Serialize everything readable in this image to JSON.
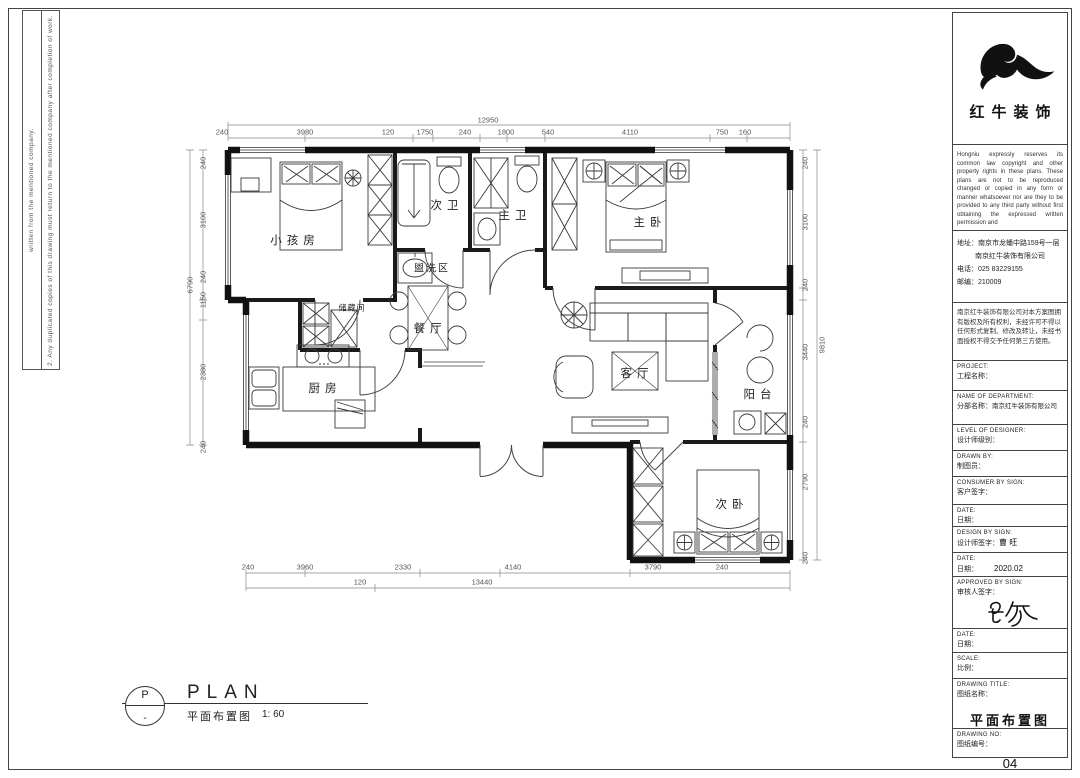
{
  "left_strip": {
    "line1": "written from the mentioned company.",
    "line2": "2. Any duplicated copies of this drawing must return to the mentioned company after completion of work."
  },
  "logo": {
    "name": "红牛装饰"
  },
  "tb": {
    "disclaimer_en": "Hongniu expressly reserves its common law copyright and other property rights in these plans. These plans are not to be reproduced changed or copied in any form or manner whatsoever nor are they to be provided to any third party without first obtaining the expressed written permission and",
    "addr1": "地址：南京市龙蟠中路159号一层",
    "addr2": "南京红牛装饰有限公司",
    "phone": "电话：025 83229155",
    "post": "邮编：210009",
    "disclaimer_cn": "南京红牛装饰有限公司对本方案图拥有版权及所有权利，未经许可不得以任何形式复制、修改及转让，未经书面授权不得交予任何第三方使用。",
    "f1e": "PROJECT:",
    "f1c": "工程名称：",
    "f2e": "NAME OF DEPARTMENT:",
    "f2c": "分部名称：",
    "f2v": "南京红牛装饰有限公司",
    "f3e": "LEVEL OF DESIGNER:",
    "f3c": "设计师级别：",
    "f4e": "DRAWN BY:",
    "f4c": "制图员：",
    "f5e": "CONSUMER BY SIGN:",
    "f5c": "客户签字：",
    "f6e": "DATE:",
    "f6c": "日期：",
    "f7e": "DESIGN BY SIGN:",
    "f7c": "设计师签字：",
    "f7v": "曹 旺",
    "f8e": "DATE:",
    "f8c": "日期：",
    "f8v": "2020.02",
    "f9e": "APPROVED BY SIGN:",
    "f9c": "审核人签字：",
    "f10e": "DATE:",
    "f10c": "日期：",
    "f11e": "SCALE:",
    "f11c": "比例：",
    "f12e": "DRAWING TITLE:",
    "f12c": "图纸名称：",
    "f12v": "平面布置图",
    "f13e": "DRAWING NO:",
    "f13c": "图纸编号：",
    "f13v": "04"
  },
  "rooms": {
    "kids": "小孩房",
    "bath2": "次卫",
    "bath1": "主卫",
    "master": "主卧",
    "wash": "盥洗区",
    "storage": "储藏间",
    "dining": "餐厅",
    "kitchen": "厨房",
    "living": "客厅",
    "balcony": "阳台",
    "bed2": "次卧"
  },
  "dims": {
    "top_total": "12950",
    "top": [
      "240",
      "3980",
      "120",
      "1750",
      "240",
      "1800",
      "540",
      "4110",
      "750",
      "160"
    ],
    "bottom": [
      "240",
      "3960",
      "2330",
      "4140",
      "3790",
      "240"
    ],
    "bottom_sub": "120",
    "bottom_total": "13440",
    "left": [
      "240",
      "3100",
      "240",
      "1150",
      "2380",
      "240"
    ],
    "left_total": "6790",
    "right": [
      "240",
      "3100",
      "240",
      "3440",
      "240",
      "2790",
      "240"
    ],
    "right_total": "9810"
  },
  "footer": {
    "marker_top": "P",
    "marker_bottom": "-",
    "title": "PLAN",
    "subtitle": "平面布置图",
    "scale": "1: 60"
  }
}
